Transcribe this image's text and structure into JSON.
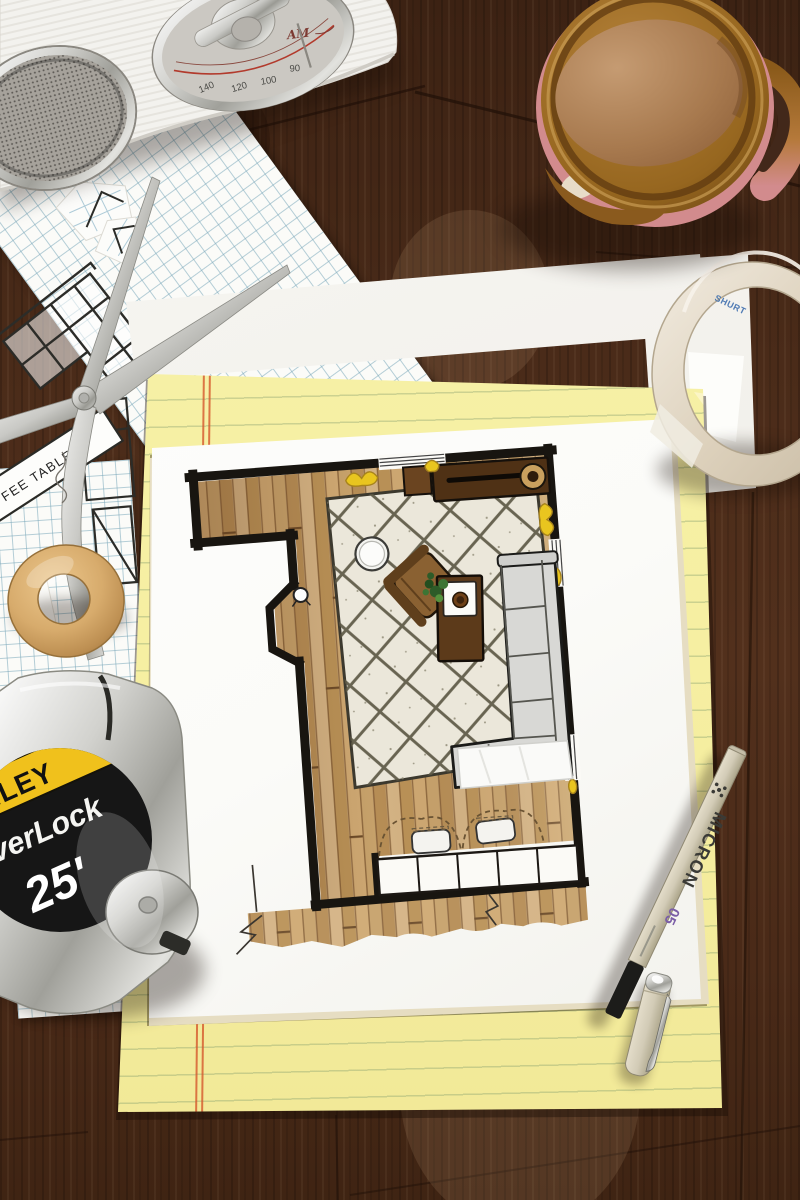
{
  "scene": {
    "type": "photograph",
    "description": "Overhead desk scene: a hand-drawn and marker-rendered living-room floor plan on white paper lies on a yellow legal pad, surrounded by a vintage radio, mug of milky coffee, masking tape roll, all-metal scissors, graph-paper sketches, a wooden ring, a Stanley tape measure and a Micron drafting pen on a dark wood table",
    "colors": {
      "wood_table": "#46291a",
      "pad_yellow": "#f6efa2",
      "margin_red": "#d2583a",
      "paper_white": "#fcfcfa",
      "graph_blue": "#7aa8ba",
      "rug_cream": "#ebe7da",
      "plank_tan": "#c39c66",
      "wall_black": "#1b1712",
      "sofa_gray": "#d7d7d4",
      "accent_yellow": "#e9c51f",
      "plant_green": "#2d5b28",
      "mug_brown": "#96661f",
      "mug_pink": "#d28b8d",
      "chrome": "#c9c9c5",
      "stanley_yellow": "#f0c11c",
      "micron_purple": "#7b5ea7"
    }
  },
  "radio": {
    "band_label": "AM",
    "dial_numbers": [
      "140",
      "120",
      "100",
      "90"
    ]
  },
  "tape_measure": {
    "brand_text_visible": "NLEY",
    "model_text_visible": "verLock",
    "length_label": "25'"
  },
  "pen": {
    "brand": "MICRON",
    "nib_size": "05"
  },
  "masking_tape": {
    "core_text_visible": "SHURT"
  },
  "sketch_notes": {
    "coffee_table_label_visible": "FEE TABLE",
    "small_label_visible": "TO"
  },
  "floor_plan": {
    "depicts": "living room plan",
    "furniture": [
      "media console with record player",
      "diamond lattice rug",
      "armchair",
      "round side table",
      "floor lamp",
      "coffee table with plant and tray",
      "L-shaped sectional sofa with throw blanket",
      "lower cabinets with dashed door swings",
      "two poufs"
    ]
  }
}
